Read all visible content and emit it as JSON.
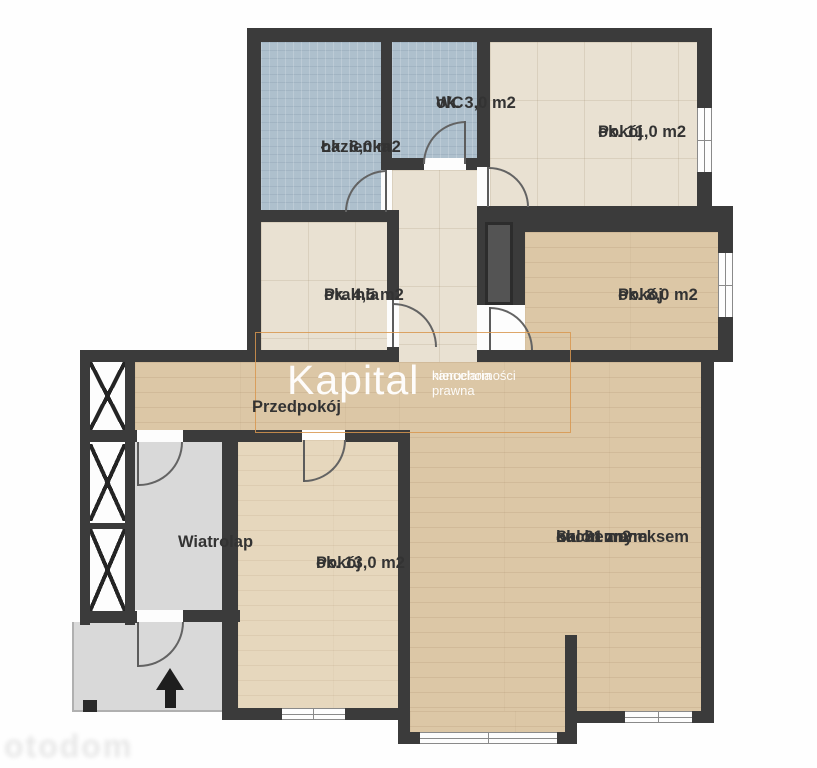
{
  "rooms": {
    "lazienka": {
      "name": "Łazienka",
      "area": "ok. 8,0 m2"
    },
    "wc": {
      "name": "WC",
      "area": "ok. 3,0 m2"
    },
    "pokoj_11": {
      "name": "Pokój",
      "area": "ok. 11,0 m2"
    },
    "pralnia": {
      "name": "Pralnia",
      "area": "ok. 4,5 m2"
    },
    "pokoj_8": {
      "name": "Pokój",
      "area": "ok. 8,0 m2"
    },
    "przedpokoj": {
      "name": "Przedpokój"
    },
    "wiatrolap": {
      "name": "Wiatrolap"
    },
    "pokoj_13": {
      "name": "Pokój",
      "area": "ok. 13,0 m2"
    },
    "salon": {
      "name_line1": "Salon z aneksem",
      "name_line2": "kuchennym",
      "area": "ok. 31 m2"
    }
  },
  "watermark": {
    "brand": "Kapital",
    "tagline_line1": "nieruchomości",
    "tagline_line2": "kancelaria prawna"
  },
  "corner_watermark": {
    "text": "otodom"
  },
  "colors": {
    "wall": "#3b3b3b",
    "tile_blue": "#aec0cd",
    "tile_beige": "#e9e1d2",
    "wood": "#dcc7a6",
    "wood_pale": "#e6d7bd",
    "floor_gray": "#d9d9d9",
    "watermark_orange": "#d8964f",
    "label_text": "#333333"
  }
}
